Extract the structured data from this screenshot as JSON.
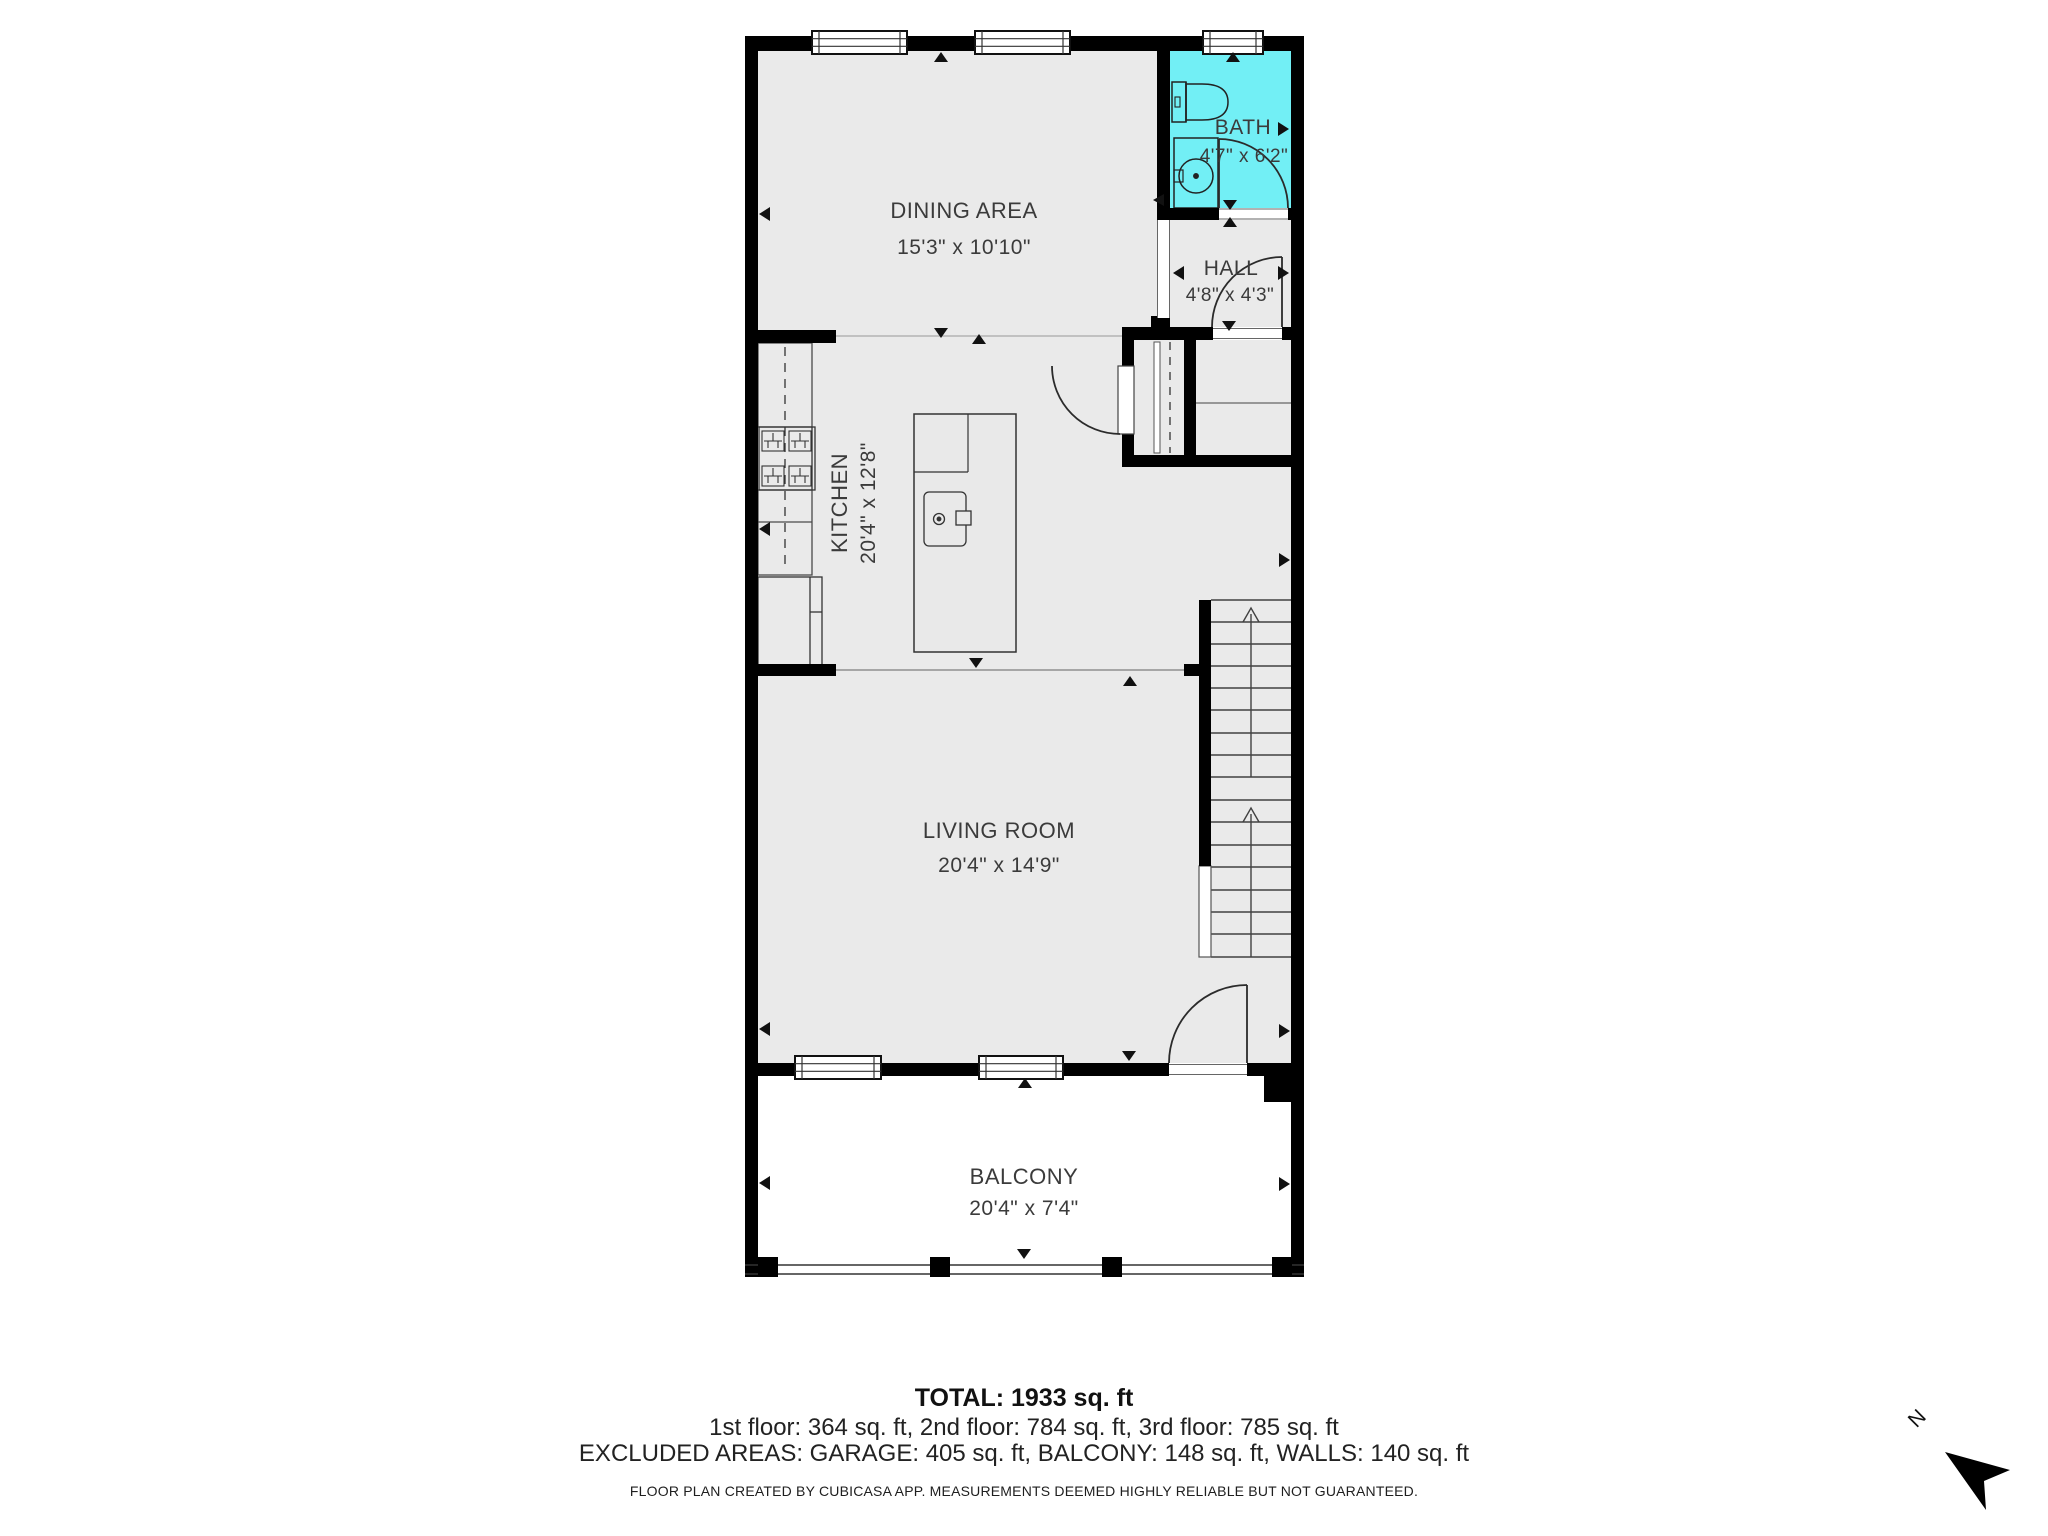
{
  "plan": {
    "rooms": [
      {
        "id": "dining",
        "label": "DINING AREA",
        "dims": "15'3\" x 10'10\""
      },
      {
        "id": "bath",
        "label": "BATH",
        "dims": "4'7\" x 6'2\""
      },
      {
        "id": "hall",
        "label": "HALL",
        "dims": "4'8\" x 4'3\""
      },
      {
        "id": "kitchen",
        "label": "KITCHEN",
        "dims": "20'4\" x 12'8\""
      },
      {
        "id": "living",
        "label": "LIVING ROOM",
        "dims": "20'4\" x 14'9\""
      },
      {
        "id": "balcony",
        "label": "BALCONY",
        "dims": "20'4\" x 7'4\""
      }
    ],
    "colors": {
      "bath_fill": "#72EFF5",
      "room_fill": "#EAEAEA",
      "wall": "#000000"
    }
  },
  "summary": {
    "total": "TOTAL: 1933 sq. ft",
    "floors": "1st floor: 364 sq. ft, 2nd floor: 784 sq. ft, 3rd floor: 785 sq. ft",
    "excluded": "EXCLUDED AREAS: GARAGE: 405 sq. ft, BALCONY: 148 sq. ft, WALLS: 140 sq. ft",
    "disclaimer": "FLOOR PLAN CREATED BY CUBICASA APP. MEASUREMENTS DEEMED HIGHLY RELIABLE BUT NOT GUARANTEED."
  },
  "compass": {
    "north_label": "N"
  }
}
